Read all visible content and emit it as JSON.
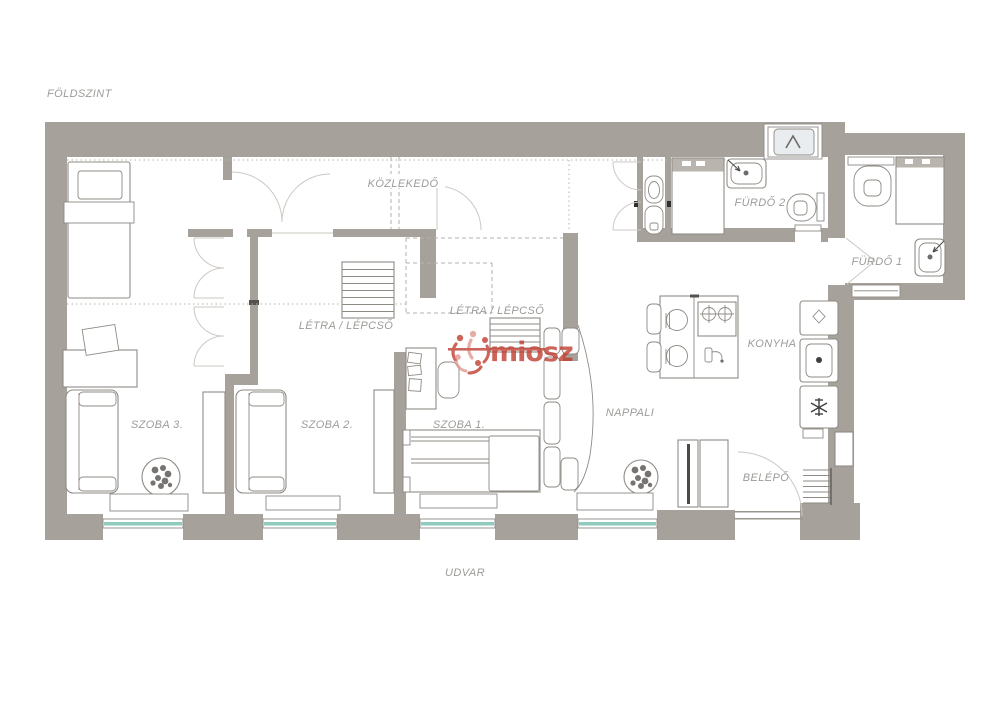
{
  "page": {
    "floor_label": "FÖLDSZINT",
    "courtyard_label": "UDVAR"
  },
  "rooms": {
    "hallway": "KÖZLEKEDŐ",
    "stairs_upper": "LÉTRA / LÉPCSŐ",
    "stairs_lower": "LÉTRA / LÉPCSŐ",
    "room3": "SZOBA 3.",
    "room2": "SZOBA 2.",
    "room1": "SZOBA 1.",
    "living_room": "NAPPALI",
    "kitchen": "KONYHA",
    "bathroom2": "FÜRDŐ 2",
    "bathroom1": "FÜRDŐ 1",
    "entry": "BELÉPŐ"
  },
  "watermark": {
    "text": "miosz",
    "color": "#c0392b"
  },
  "colors": {
    "wall": "#a7a19b",
    "window_glass": "#8fccbe",
    "label_text": "#9b9b98",
    "watermark_red": "#c0392b"
  }
}
